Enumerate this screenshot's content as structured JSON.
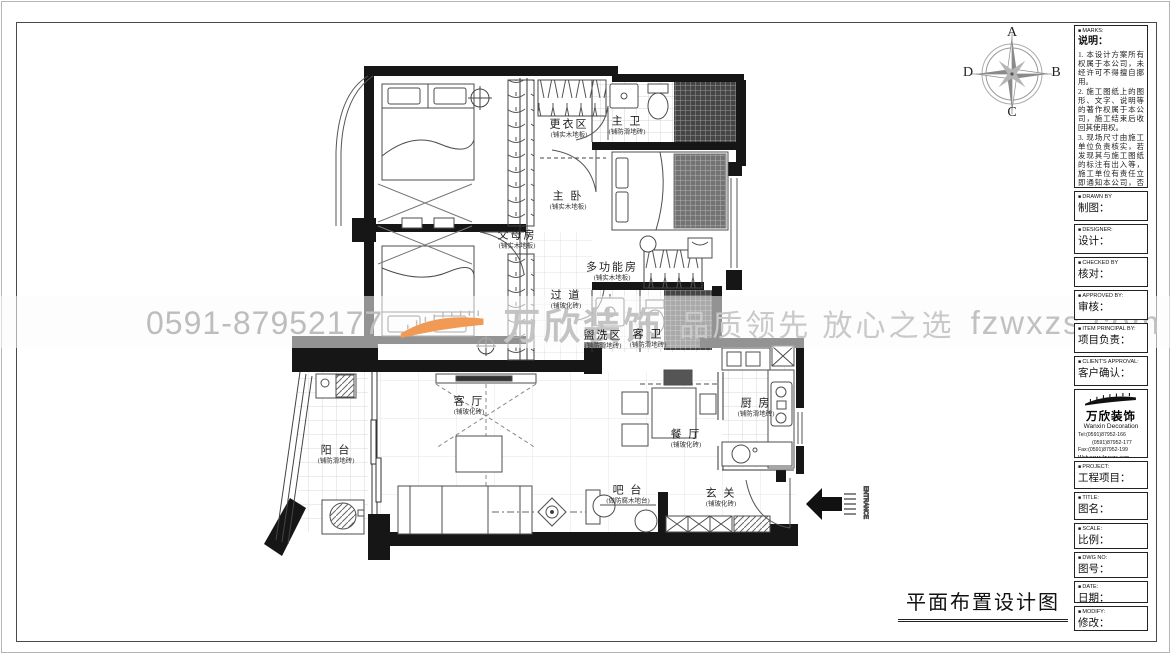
{
  "sheet": {
    "title": "平面布置设计图"
  },
  "compass": {
    "n": "A",
    "e": "B",
    "s": "C",
    "w": "D"
  },
  "watermark": {
    "phone": "0591-87952177",
    "brand": "万欣装饰",
    "slogan": "品质领先 放心之选",
    "site": "fzwxzs.com",
    "orange": "#f09a55",
    "gray": "#c3c3c3"
  },
  "plan": {
    "entrance": "ENTRANCE"
  },
  "rooms": [
    {
      "name": "更衣区",
      "sub": "(铺实木地板)"
    },
    {
      "name": "主 卫",
      "sub": "(铺防滑地砖)"
    },
    {
      "name": "主 卧",
      "sub": "(铺实木地板)"
    },
    {
      "name": "父母房",
      "sub": "(铺实木地板)"
    },
    {
      "name": "多功能房",
      "sub": "(铺实木地板)"
    },
    {
      "name": "过 道",
      "sub": "(铺玻化砖)"
    },
    {
      "name": "盥洗区",
      "sub": "(铺防滑地砖)"
    },
    {
      "name": "客 卫",
      "sub": "(铺防滑地砖)"
    },
    {
      "name": "客 厅",
      "sub": "(铺玻化砖)"
    },
    {
      "name": "餐 厅",
      "sub": "(铺玻化砖)"
    },
    {
      "name": "厨 房",
      "sub": "(铺防滑地砖)"
    },
    {
      "name": "阳 台",
      "sub": "(铺防滑地砖)"
    },
    {
      "name": "吧 台",
      "sub": "(做防腐木地台)"
    },
    {
      "name": "玄 关",
      "sub": "(铺玻化砖)"
    }
  ],
  "titleblock": {
    "marks": {
      "en": "MARKS:",
      "cn": "说明："
    },
    "notes": [
      "1. 本设计方案所有权属于本公司，未经许可不得擅自挪用。",
      "2. 施工图纸上的图形、文字、说明等的著作权属于本公司，施工结束后收回其使用权。",
      "3. 现场尺寸由施工单位负责核实，若发现其与施工图纸的标注有出入等，施工单位有责任立即通知本公司，否则施工单位将承担所有责任。",
      "4. 本设计方案是依客户要求设计，经客户签字即视为同意认可，不得随意更改。"
    ],
    "fieldsA": [
      {
        "en": "DRAWN BY",
        "cn": "制图："
      },
      {
        "en": "DESIGNER:",
        "cn": "设计："
      },
      {
        "en": "CHECKED BY",
        "cn": "核对："
      },
      {
        "en": "APPROVED BY:",
        "cn": "审核："
      },
      {
        "en": "ITEM PRINCIPAL BY:",
        "cn": "项目负责："
      },
      {
        "en": "CLIENT'S APPROVAL:",
        "cn": "客户确认："
      }
    ],
    "logo": {
      "brand": "万欣装饰",
      "brand_en": "Wanxin Decoration",
      "tel1": "Tel:(0591)87952-166",
      "tel2": "(0591)87952-177",
      "fax": "Fax:(0591)87952-199",
      "web": "Web:www.fzwxzs.com"
    },
    "fieldsB": [
      {
        "en": "PROJECT:",
        "cn": "工程项目："
      },
      {
        "en": "TITLE:",
        "cn": "图名："
      },
      {
        "en": "SCALE:",
        "cn": "比例："
      },
      {
        "en": "DWG NO:",
        "cn": "图号："
      },
      {
        "en": "DATE:",
        "cn": "日期："
      },
      {
        "en": "MODIFY:",
        "cn": "修改："
      }
    ]
  }
}
